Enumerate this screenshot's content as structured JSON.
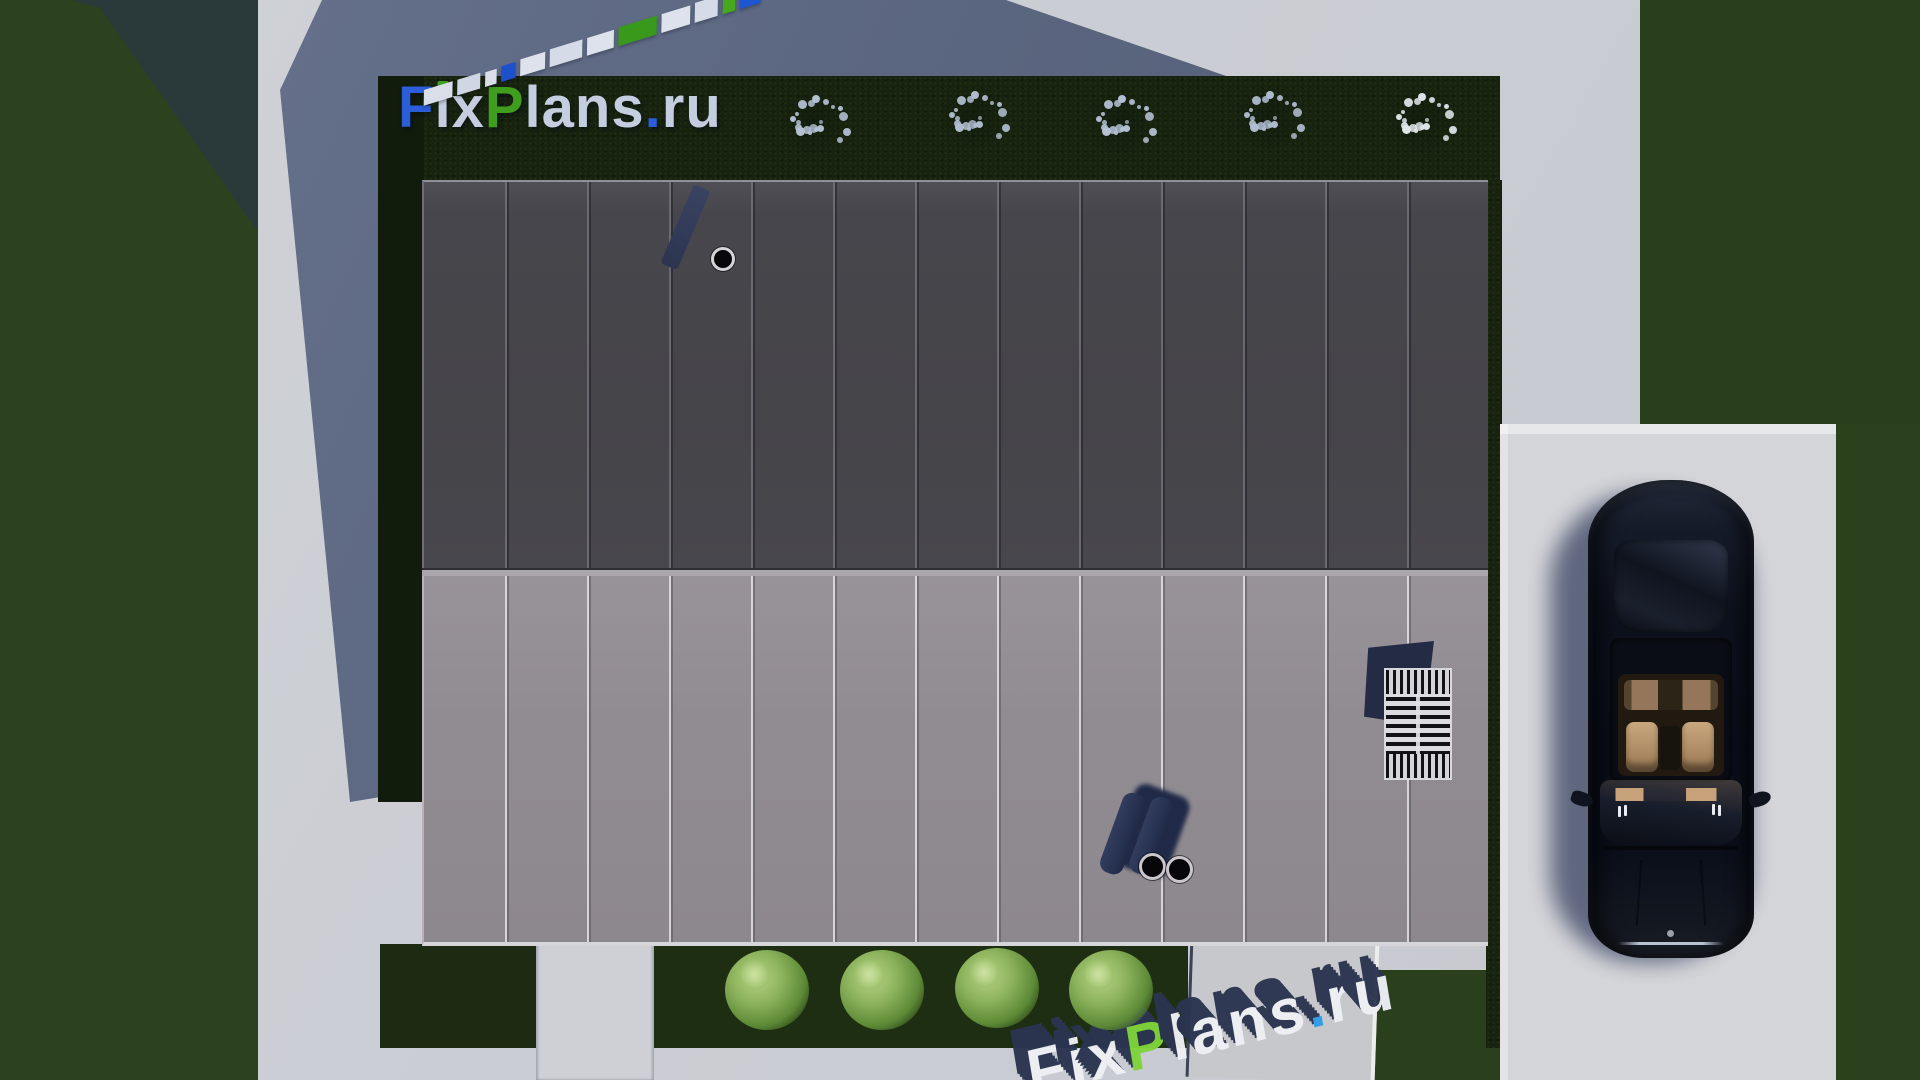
{
  "scene": {
    "description": "Top-down 3D architectural render of a modern flat-roof house with a two-tone standing-seam metal roof, lawns, hedge borders, gravel path, driveway and a parked dark sedan",
    "branding_text": "FixPlans.ru"
  },
  "palette": {
    "concrete_lit": "#cbced4",
    "concrete_shadow": "#5b6680",
    "grass": "#2c421e",
    "hedge_shadow": "#17230f",
    "roof_upper": "#47464c",
    "roof_lower": "#918c92",
    "roof_edge_light": "#d6d6da",
    "logo_blue": "#2b5ed8",
    "logo_green": "#3f9e1d",
    "logo_light": "#c5cde0",
    "watermark_navy": "#2c3550",
    "watermark_face_green": "#7ed43b",
    "watermark_face_blue": "#2f9ce9",
    "pipe_navy": "#273252",
    "car_body": "#0c101c",
    "car_seats": "#c9a87f",
    "driveway": "#d4d5d9"
  },
  "logo": {
    "text": "FixPlans.ru",
    "segments": [
      {
        "t": "F",
        "c": "#2b5ed8"
      },
      {
        "t": "i",
        "c": "#c5cde0",
        "dot": "#3f9e1d"
      },
      {
        "t": "x",
        "c": "#c5cde0"
      },
      {
        "t": "P",
        "c": "#3f9e1d"
      },
      {
        "t": "l",
        "c": "#c5cde0"
      },
      {
        "t": "a",
        "c": "#c5cde0"
      },
      {
        "t": "n",
        "c": "#c5cde0"
      },
      {
        "t": "s",
        "c": "#c5cde0"
      },
      {
        "t": ".",
        "c": "#2b5ed8"
      },
      {
        "t": "r",
        "c": "#c5cde0"
      },
      {
        "t": "u",
        "c": "#c5cde0"
      }
    ]
  },
  "watermark_bottom": {
    "text": "FixPlans.ru",
    "extrusion": "#2c3550",
    "segments": [
      {
        "t": "F",
        "c": "#eef0f4"
      },
      {
        "t": "i",
        "c": "#eef0f4"
      },
      {
        "t": "x",
        "c": "#eef0f4"
      },
      {
        "t": "P",
        "c": "#7ed43b"
      },
      {
        "t": "l",
        "c": "#eef0f4"
      },
      {
        "t": "a",
        "c": "#eef0f4"
      },
      {
        "t": "n",
        "c": "#eef0f4"
      },
      {
        "t": "s",
        "c": "#eef0f4"
      },
      {
        "t": ".",
        "c": "#2f9ce9"
      },
      {
        "t": "r",
        "c": "#eef0f4"
      },
      {
        "t": "u",
        "c": "#eef0f4"
      }
    ]
  },
  "watermark_diagonal": {
    "text": "FixPlans.ru",
    "blocks": [
      {
        "w": 30,
        "h": 15,
        "c": "#d9dee9"
      },
      {
        "w": 24,
        "h": 15,
        "c": "#cfd6e4"
      },
      {
        "w": 12,
        "h": 14,
        "c": "#d9dee9"
      },
      {
        "w": 15,
        "h": 15,
        "c": "#1d50cb"
      },
      {
        "w": 26,
        "h": 16,
        "c": "#dde2ec"
      },
      {
        "w": 34,
        "h": 17,
        "c": "#d5dbe7"
      },
      {
        "w": 28,
        "h": 17,
        "c": "#dde2ec"
      },
      {
        "w": 40,
        "h": 18,
        "c": "#39991b"
      },
      {
        "w": 30,
        "h": 18,
        "c": "#dde2ec"
      },
      {
        "w": 24,
        "h": 19,
        "c": "#d5dbe7"
      },
      {
        "w": 13,
        "h": 17,
        "c": "#46a81f"
      },
      {
        "w": 22,
        "h": 19,
        "c": "#1d55d2"
      }
    ]
  },
  "landscape": {
    "white_bushes": [
      {
        "x": 814,
        "y": 122,
        "tone": "#b7c3d6"
      },
      {
        "x": 973,
        "y": 118,
        "tone": "#b2bed2"
      },
      {
        "x": 1120,
        "y": 122,
        "tone": "#b7c3d6"
      },
      {
        "x": 1268,
        "y": 118,
        "tone": "#b2bed2"
      },
      {
        "x": 1420,
        "y": 120,
        "tone": "#e2e7ec"
      }
    ],
    "green_bushes": [
      {
        "x": 767,
        "y": 990
      },
      {
        "x": 882,
        "y": 990
      },
      {
        "x": 997,
        "y": 988
      },
      {
        "x": 1111,
        "y": 990
      }
    ]
  },
  "roof": {
    "sections": 2,
    "panels_per_section": 13,
    "chimneys": 1,
    "vent_pipes": 2,
    "skylight": true
  }
}
